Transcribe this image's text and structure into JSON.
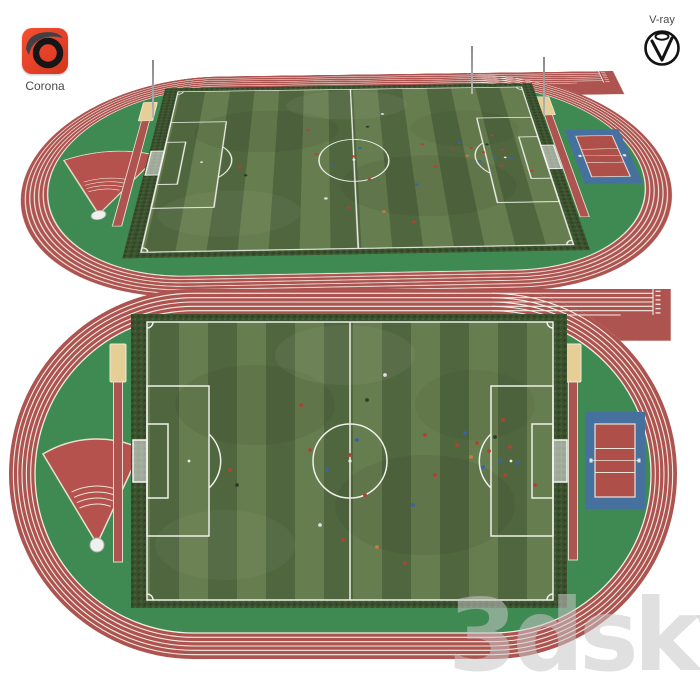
{
  "header": {
    "corona": {
      "label": "Corona"
    },
    "vray": {
      "label": "V-ray"
    }
  },
  "watermark": {
    "text": "3dsky"
  },
  "scene": {
    "subject": "athletics stadium with soccer field",
    "views": [
      "perspective",
      "top-down"
    ],
    "track": {
      "lanes": 6
    },
    "features": [
      "running-track",
      "soccer-field",
      "throwing-sector",
      "long-jump-runways",
      "sand-pits",
      "volleyball-court",
      "perimeter-hedge",
      "goals",
      "players"
    ]
  },
  "colors": {
    "track_red": "#AD5350",
    "lane_line": "#F4EFE6",
    "infield_green": "#3E8A52",
    "grass_light": "#667D4F",
    "grass_dark": "#50663F",
    "hedge_green": "#3C522F",
    "sand_tan": "#E6CF97",
    "volleyball_blue": "#46719F",
    "volleyball_red": "#AF4F49",
    "sector_red": "#B5524E",
    "corona_orange": "#E8432A",
    "watermark_gray": "#C7C7C7"
  }
}
